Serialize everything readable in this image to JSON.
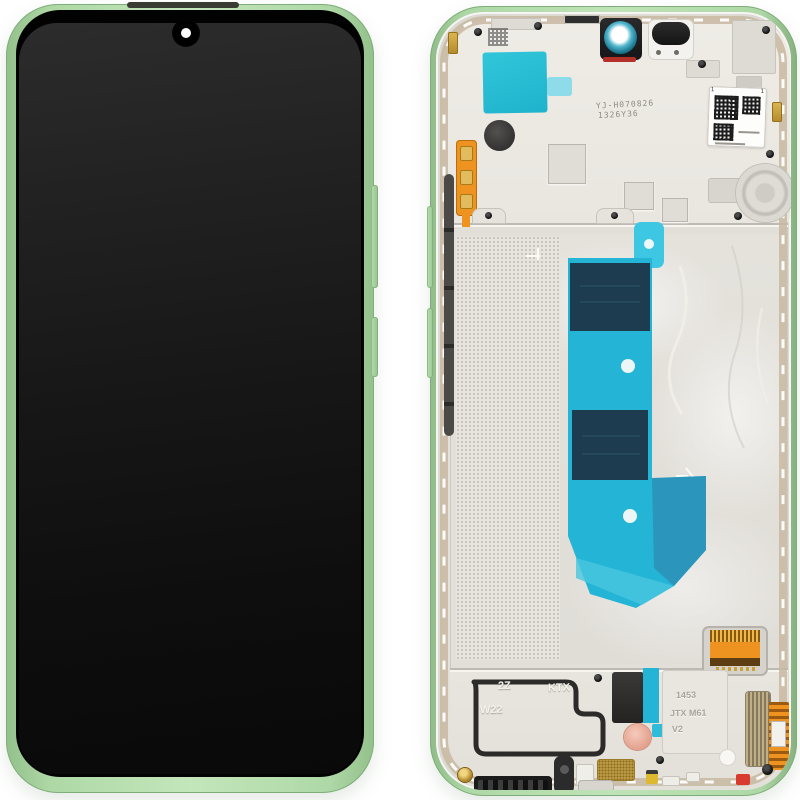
{
  "markings": {
    "top_code_line1": "YJ-H070826",
    "top_code_line2": "1326Y36",
    "qr_mark_left": "1",
    "qr_mark_right": "1",
    "speaker_mark_a": "2Z",
    "speaker_mark_b": "KTX",
    "speaker_mark_c": "W22",
    "sim_mark_a": "1453",
    "sim_mark_b": "JTX M61",
    "sim_mark_c": "V2"
  },
  "colors": {
    "frame_green": "#aed8a6",
    "frame_green_deep": "#93c08b",
    "chassis_silver": "#e9e6e0",
    "tape_teal": "#23b4d6",
    "tape_teal_bright": "#3ec7e2",
    "tape_navy": "#1d3c50",
    "tape_blue_fold": "#2c93b8",
    "flex_orange": "#ef9320",
    "adhesive_tan": "#c8b9a1",
    "camera_red": "#b23028",
    "pad_gold": "#e2bb5e",
    "accent_red": "#d83a30",
    "accent_pink": "#eeb4a3",
    "accent_yellow": "#ddb92f"
  }
}
